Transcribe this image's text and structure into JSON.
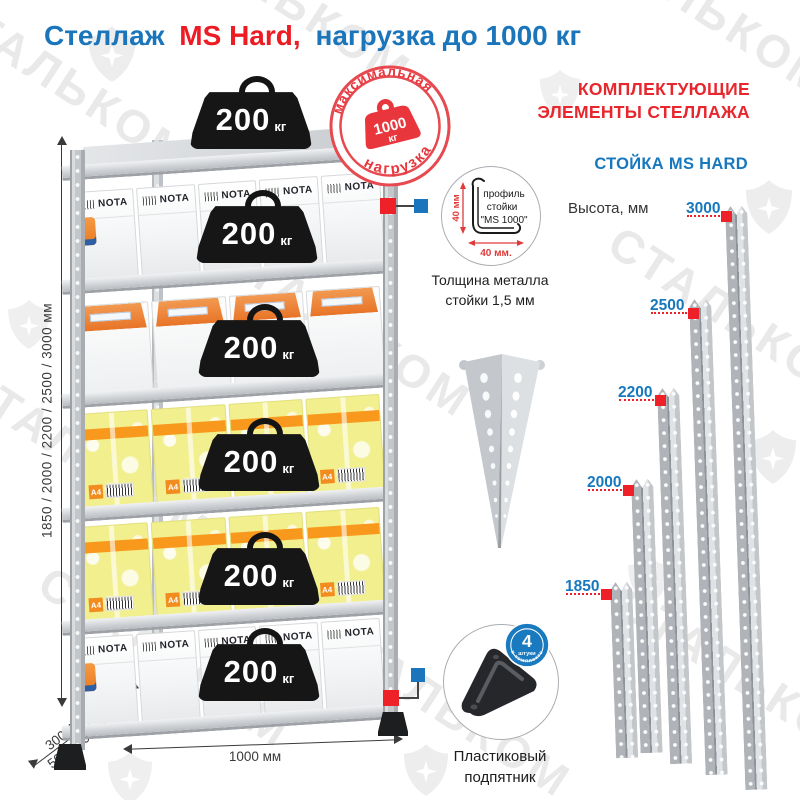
{
  "title": {
    "prefix": "Стеллаж",
    "model": "MS Hard,",
    "suffix": "нагрузка до 1000 кг"
  },
  "watermark": {
    "brand": "СТАЛЬКОМ"
  },
  "stamp": {
    "arc_top": "максимальная",
    "arc_bottom": "нагрузка",
    "value": "1000",
    "unit": "кг"
  },
  "rack": {
    "weights": [
      {
        "value": "200",
        "unit": "кг"
      },
      {
        "value": "200",
        "unit": "кг"
      },
      {
        "value": "200",
        "unit": "кг"
      },
      {
        "value": "200",
        "unit": "кг"
      },
      {
        "value": "200",
        "unit": "кг"
      },
      {
        "value": "200",
        "unit": "кг"
      }
    ],
    "box_labels": {
      "white": "NOTA",
      "yellow": "A4"
    }
  },
  "dimensions": {
    "height_label": "1850 / 2000 / 2200 / 2500 / 3000 мм",
    "depth_line1": "300/400/",
    "depth_line2": "500/600 мм",
    "width_label": "1000 мм"
  },
  "profile_detail": {
    "label_line1": "профиль",
    "label_line2": "стойки",
    "label_line3": "\"MS 1000\"",
    "dim_vertical": "40 мм",
    "dim_horizontal": "40 мм.",
    "caption_line1": "Толщина металла",
    "caption_line2": "стойки 1,5 мм"
  },
  "foot_detail": {
    "badge_count": "4",
    "badge_unit": "штуки",
    "badge_arc": "в комплекте",
    "caption_line1": "Пластиковый",
    "caption_line2": "подпятник"
  },
  "components": {
    "heading_line1": "КОМПЛЕКТУЮЩИЕ",
    "heading_line2": "ЭЛЕМЕНТЫ СТЕЛЛАЖА",
    "subheading": "СТОЙКА MS HARD",
    "height_label": "Высота, мм",
    "post_heights": [
      "3000",
      "2500",
      "2200",
      "2000",
      "1850"
    ]
  },
  "colors": {
    "blue": "#1a75bb",
    "red": "#ec1c24",
    "stamp_red": "#e8363c",
    "orange": "#f8991d",
    "post_gray": "#c6cacd"
  }
}
